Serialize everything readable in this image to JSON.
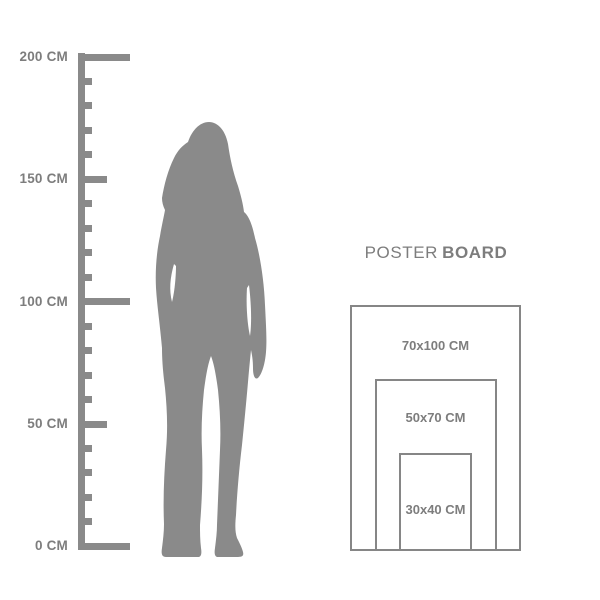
{
  "colors": {
    "background": "#ffffff",
    "gray": "#8a8a8a",
    "text": "#7d7d7d",
    "border": "#868686"
  },
  "ruler": {
    "unit": "CM",
    "max_cm": 200,
    "tick_step_cm": 10,
    "medium_tick_every_cm": 50,
    "major_tick_every_cm": 100,
    "labeled_ticks": [
      {
        "value": 200,
        "label": "200 CM"
      },
      {
        "value": 150,
        "label": "150 CM"
      },
      {
        "value": 100,
        "label": "100 CM"
      },
      {
        "value": 50,
        "label": "50 CM"
      },
      {
        "value": 0,
        "label": "0 CM"
      }
    ]
  },
  "figure": {
    "icon": "standing-woman-silhouette"
  },
  "poster_board": {
    "title_light": "POSTER",
    "title_bold": "BOARD",
    "sizes": [
      {
        "label": "70x100 CM",
        "width_cm": 70,
        "height_cm": 100
      },
      {
        "label": "50x70 CM",
        "width_cm": 50,
        "height_cm": 70
      },
      {
        "label": "30x40 CM",
        "width_cm": 30,
        "height_cm": 40
      }
    ]
  }
}
